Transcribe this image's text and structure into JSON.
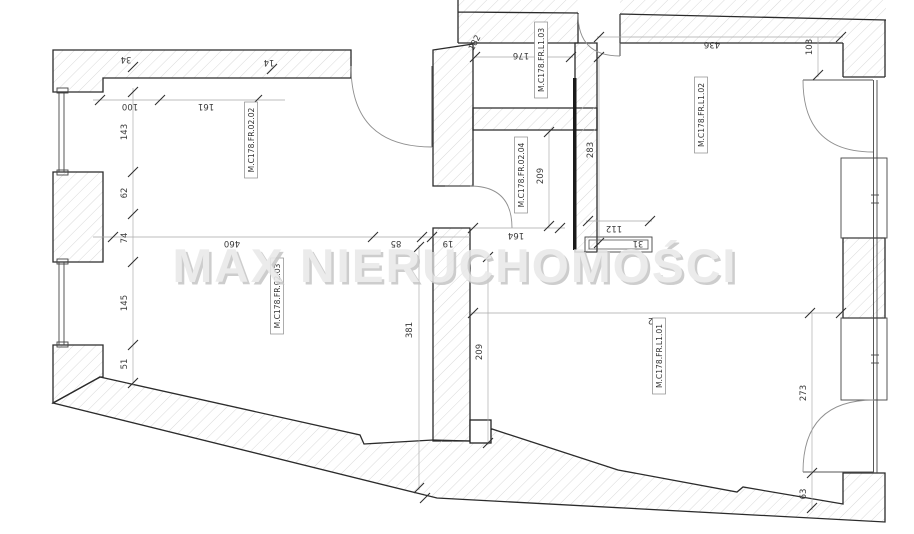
{
  "watermark": {
    "text": "MAX NIERUCHOMOŚCI",
    "color": "#e9e9e9"
  },
  "room_labels": {
    "r0202": "M.C178.FR.02.02",
    "r0203": "M.C178.FR.02.03",
    "r0204": "M.C178.FR.02.04",
    "l101": "M.C178.FR.L1.01",
    "l102": "M.C178.FR.L1.02",
    "l103": "M.C178.FR.L1.03"
  },
  "dimensions": {
    "d34": "34",
    "d14": "14",
    "d100": "100",
    "d161": "161",
    "d143": "143",
    "d62": "62",
    "d74": "74",
    "d145": "145",
    "d51": "51",
    "d460": "460",
    "d85": "85",
    "d19": "19",
    "d381": "381",
    "d209a": "209",
    "d164": "164",
    "d209b": "209",
    "d283": "283",
    "d176": "176",
    "d182": "182",
    "d436": "436",
    "d103": "103",
    "d112": "112",
    "d31": "31",
    "d632": "632",
    "d273": "273",
    "d63": "63"
  }
}
